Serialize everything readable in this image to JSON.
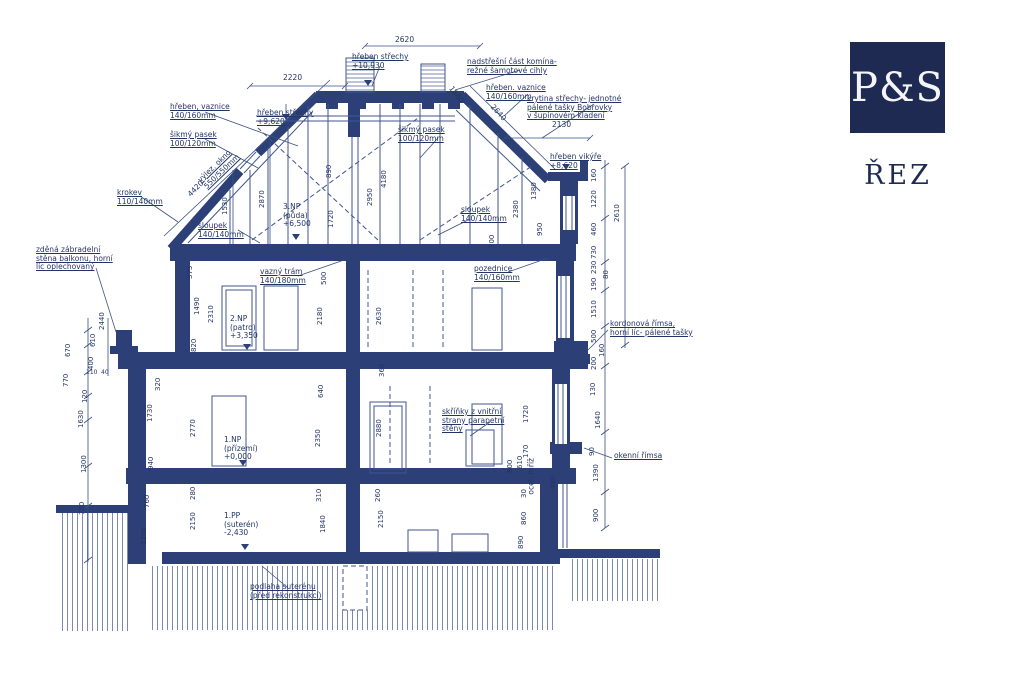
{
  "logo": {
    "monogram": "P&S",
    "caption": "ŘEZ"
  },
  "colors": {
    "wall": "#2c4077",
    "thin": "#41568f",
    "text": "#233564",
    "logo_bg": "#1f2a52"
  },
  "ann": [
    "hřeben, vaznice\n140/160mm",
    "šikmý pasek\n100/120mm",
    "krokev\n110/140mm",
    "hřeben střechy\n+9,620",
    "hřeben střechy\n+10,930",
    "nadstřešní část komína-\nrežné šamotové cihly",
    "hřeben. vaznice\n140/160mm",
    "krytina střechy- jednotné\npálené tašky Bobrovky\nv šupinovém kladení",
    "hřeben vikýře\n+8,620",
    "šikmý pasek\n100/120mm",
    "výlez. okno\n550/550mm",
    "sloupek\n140/140mm",
    "sloupek\n140/140mm",
    "3.NP\n(půda)\n+6,500",
    "vazný trám\n140/180mm",
    "pozednice\n140/160mm",
    "zděná zábradelní\nstěna balkonu, horní\nlíc oplechovaný",
    "2.NP\n(patro)\n+3,350",
    "kordonová římsa,\nhorní líc- pálené tašky",
    "skříňky z vnitřní\nstrany parapetní\nstěny",
    "okenní římsa",
    "1.NP\n(přízemí)\n+0,000",
    "ocel. mříž",
    "1.PP\n(suterén)\n-2,430",
    "podlaha suterénu\n(před rekonstrukcí)"
  ],
  "dims": [
    "2620",
    "2220",
    "2130",
    "1680",
    "2640",
    "4420",
    "1530",
    "2870",
    "890",
    "2950",
    "4180",
    "1720",
    "2380",
    "1380",
    "950",
    "300",
    "375",
    "1490",
    "2310",
    "820",
    "500",
    "2180",
    "2630",
    "320",
    "1730",
    "940",
    "760",
    "1250",
    "2770",
    "2350",
    "2880",
    "280",
    "310",
    "260",
    "2150",
    "1840",
    "2150",
    "1720",
    "170",
    "610",
    "800",
    "480",
    "30",
    "860",
    "890",
    "670",
    "770",
    "120",
    "1630",
    "1300",
    "750",
    "2440",
    "610",
    "400",
    "160",
    "1220",
    "2610",
    "460",
    "730",
    "230",
    "190",
    "80",
    "1510",
    "500",
    "160",
    "200",
    "130",
    "1640",
    "90",
    "1390",
    "900",
    "110",
    "40",
    "640",
    "360"
  ]
}
